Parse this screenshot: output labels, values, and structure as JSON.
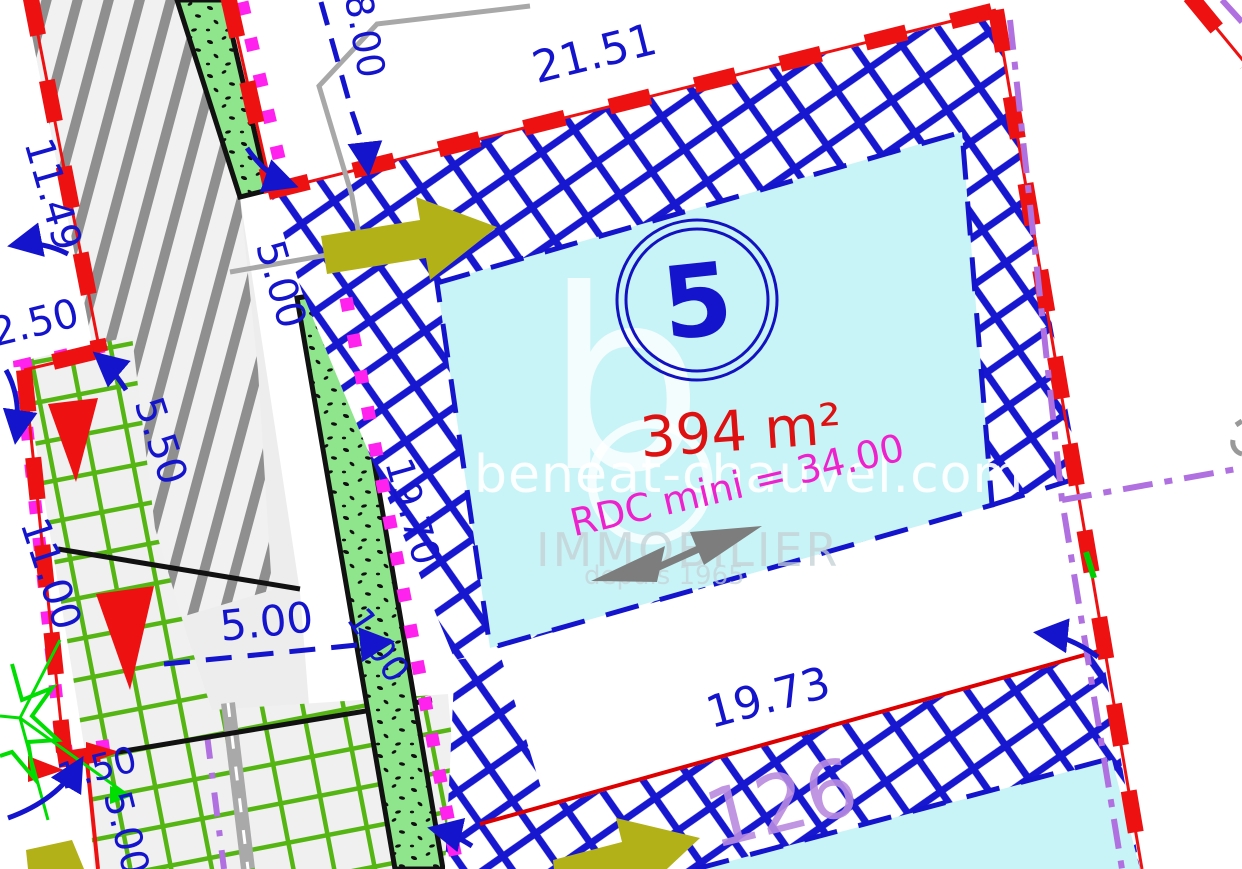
{
  "plan": {
    "lot": {
      "number": "5",
      "area": "394 m²",
      "rdc_note": "RDC mini = 34.00"
    },
    "adjacent_parcel": "126",
    "dimensions": {
      "top": "21.51",
      "top_left_vertical": "8.00",
      "left_upper": "11.49",
      "left_corner": "2.50",
      "left_diagonal": "5.50",
      "left_lower": "11.00",
      "strip_upper": "5.00",
      "strip_length": "19.70",
      "access_width": "5.00",
      "strip_width": "1.00",
      "bottom_left_small": "1.50",
      "bottom_left_vertical": "5.00",
      "bottom": "19.73"
    },
    "watermark": {
      "logo_letter": "b",
      "site": "beneat-chauvel.com",
      "brand": "IMMOBILIER",
      "since": "depuis 1965"
    },
    "colors": {
      "boundary_red": "#ee1111",
      "hatch_blue": "#1717cf",
      "buildable_cyan": "#c9f4f7",
      "grid_green": "#55b513",
      "speckle_green": "#8ee58b",
      "magenta_dots": "#ff22ee",
      "rdc_magenta": "#ee22cc",
      "violet_dashdot": "#b070e0",
      "olive_arrow": "#b2b117",
      "dimension_blue": "#1414cc",
      "area_red": "#dd1111",
      "parcel_purple": "#b98be0",
      "road_hatch_gray": "#8f8f8f"
    }
  }
}
